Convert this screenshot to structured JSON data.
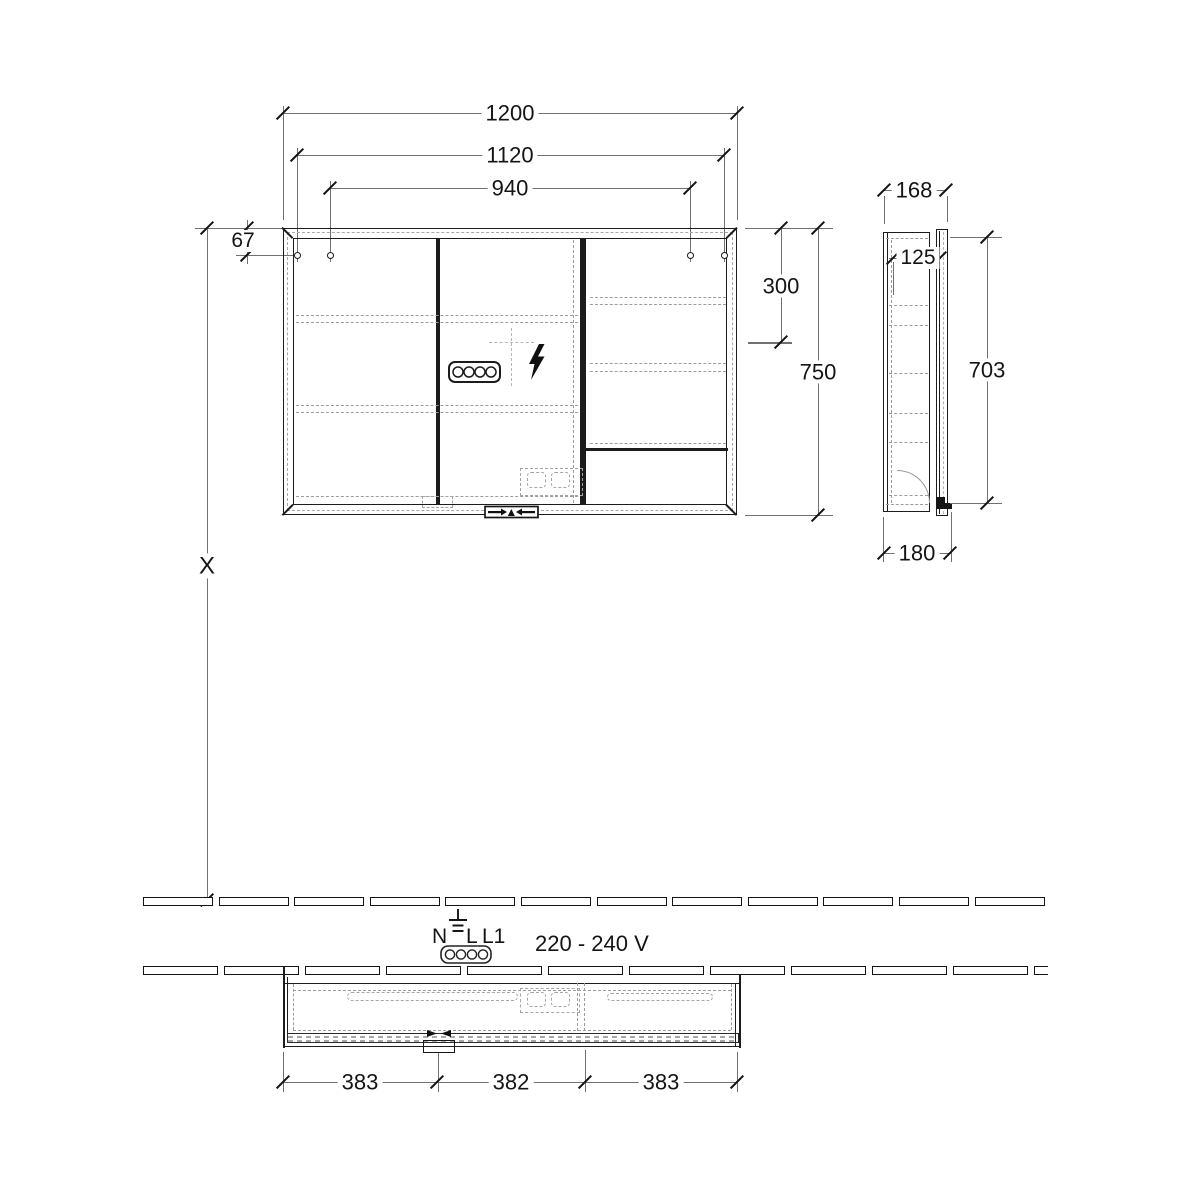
{
  "document": {
    "type": "technical_drawing",
    "subject": "Mirror cabinet installation drawing"
  },
  "front_view": {
    "width_overall": "1200",
    "mounting_width_outer": "1120",
    "mounting_width_inner": "940",
    "hole_top_offset": "67",
    "upper_zone_height": "300",
    "height_overall": "750",
    "mounting_height": "X"
  },
  "side_view": {
    "depth_overall": "168",
    "inner_depth": "125",
    "door_height": "703",
    "depth_with_door": "180"
  },
  "bottom_view": {
    "segment_left": "383",
    "segment_center": "382",
    "segment_right": "383"
  },
  "electrical": {
    "terminal_n": "N",
    "terminal_l": "L",
    "terminal_l1": "L1",
    "voltage": "220 - 240 V"
  },
  "icons": {
    "socket": "4-pin-connector-icon",
    "power": "lightning-bolt-icon",
    "ground": "earth-ground-icon"
  },
  "colors": {
    "line": "#1c1c1c",
    "dimension_line": "#707070",
    "hidden_line": "#9c9c9c",
    "background": "#ffffff"
  },
  "wall_tiles": {
    "rows": 2,
    "row_tile_counts": [
      12,
      12
    ]
  }
}
